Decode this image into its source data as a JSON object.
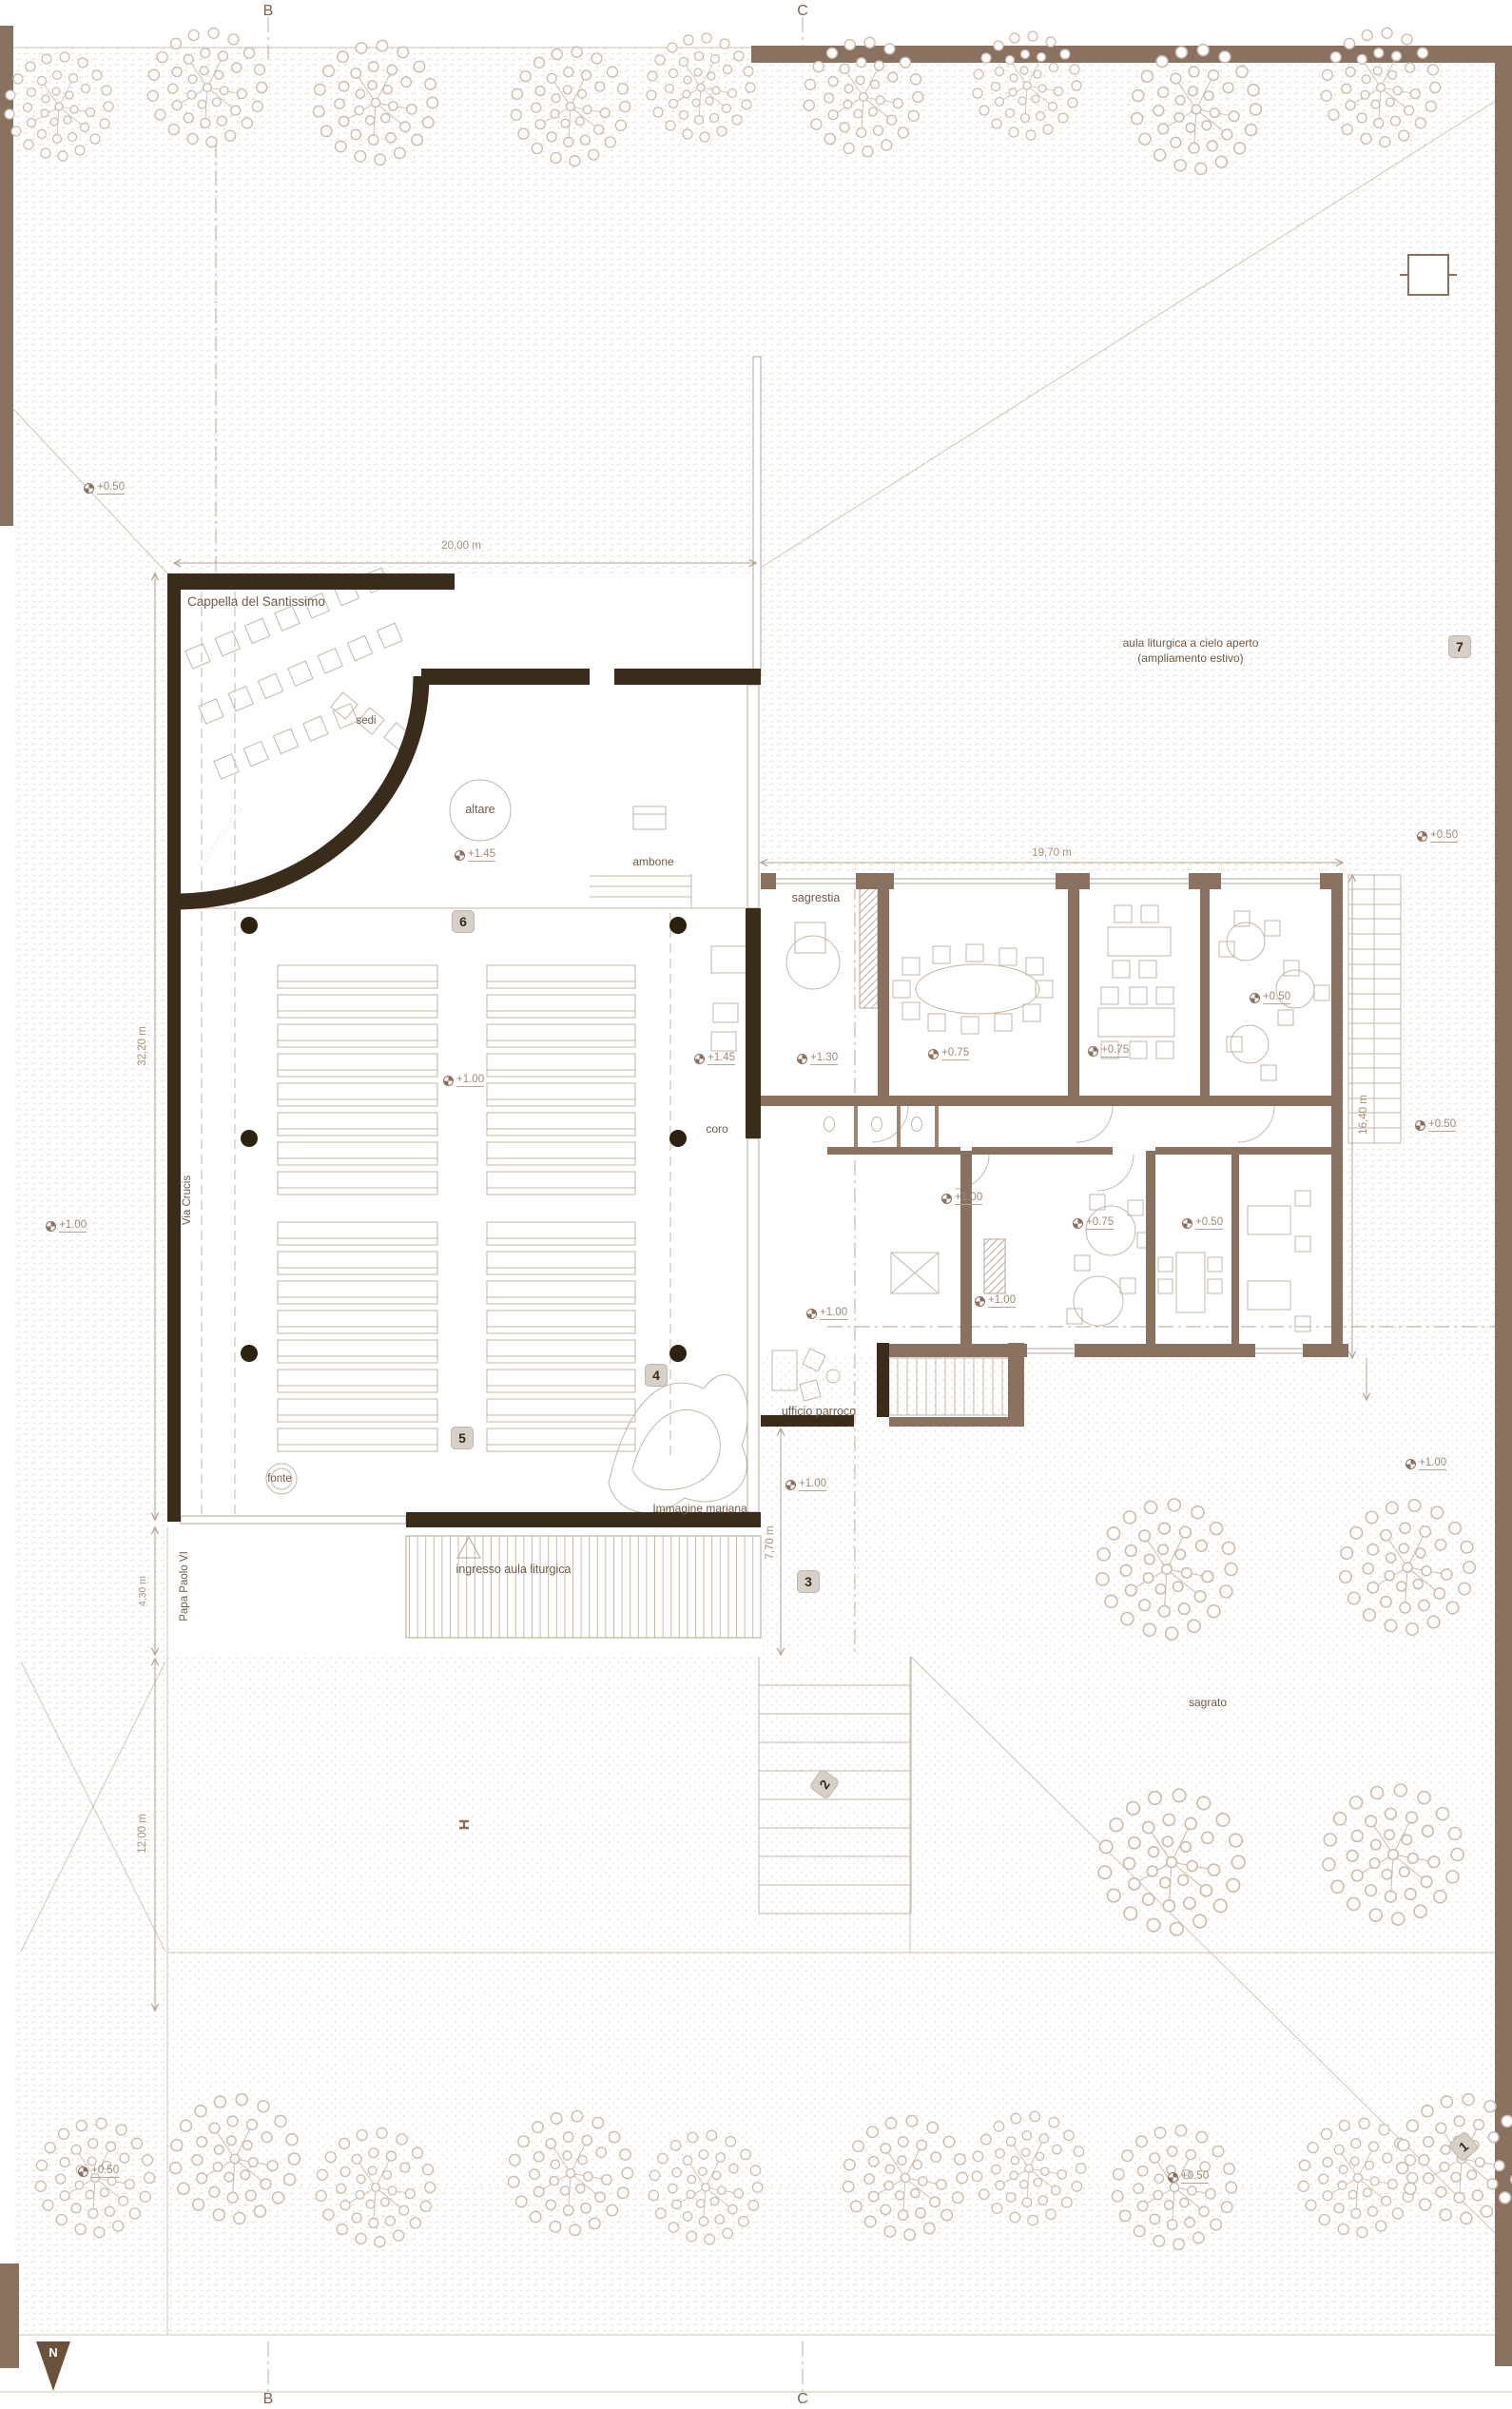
{
  "drawing": {
    "section_markers": {
      "b": "B",
      "c": "C"
    },
    "north_label": "N",
    "labels": {
      "cappella": "Cappella del Santissimo",
      "sedi": "sedi",
      "tabernacolo": "tabernacolo",
      "altare": "altare",
      "ambone": "ambone",
      "sagrestia": "sagrestia",
      "coro": "coro",
      "fonte": "fonte",
      "via_crucis": "Via Crucis",
      "papa_paolo": "Papa Paolo VI",
      "ufficio_parroco": "ufficio parroco",
      "immagine_mariana": "Immagine mariana",
      "ingresso": "ingresso aula liturgica",
      "aula_aperta_line1": "aula liturgica a cielo aperto",
      "aula_aperta_line2": "(ampliamento estivo)",
      "sagrato": "sagrato"
    },
    "dimensions": {
      "d_20": "20,00 m",
      "d_19_70": "19,70 m",
      "d_32_20": "32,20 m",
      "d_16_40": "16,40 m",
      "d_4_30": "4,30 m",
      "d_12_00": "12,00 m",
      "d_7_70": "7,70 m"
    },
    "levels": {
      "l_050": "+0.50",
      "l_075": "+0.75",
      "l_100": "+1.00",
      "l_130": "+1.30",
      "l_145": "+1.45"
    },
    "viewpoints": {
      "v1": "1",
      "v2": "2",
      "v3": "3",
      "v4": "4",
      "v5": "5",
      "v6": "6",
      "v7": "7"
    },
    "colors": {
      "wall_dark": "#3a2c1b",
      "wall_medium": "#8a7160",
      "line_light": "#c6bcae",
      "text": "#6f5b47",
      "paper": "#ffffff"
    }
  }
}
